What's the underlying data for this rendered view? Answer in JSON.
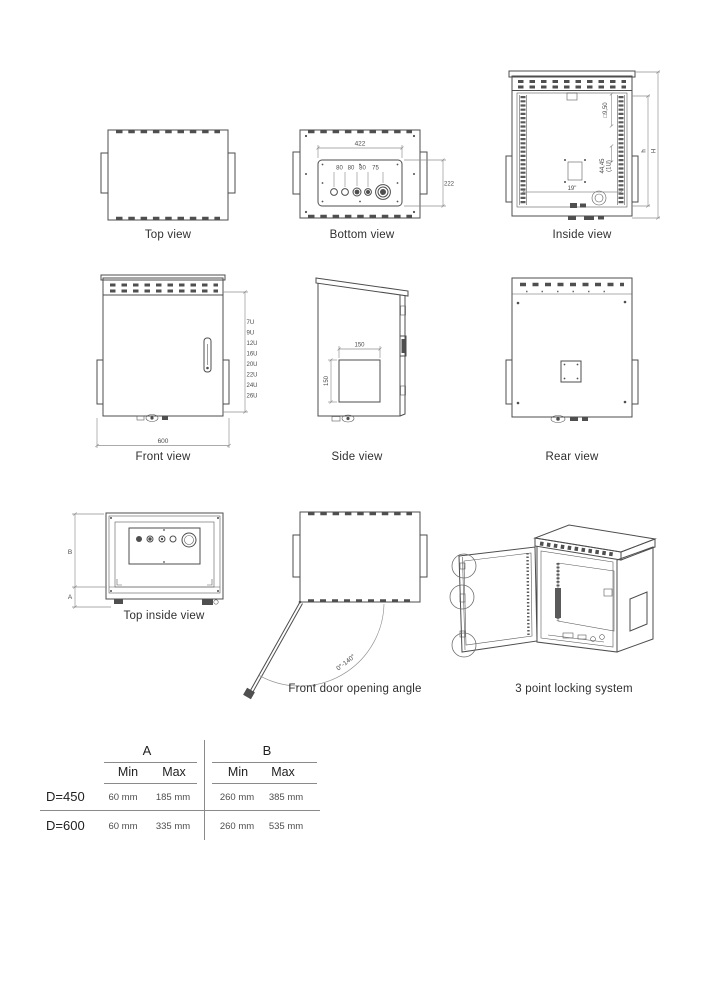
{
  "captions": {
    "top": "Top view",
    "bottom": "Bottom view",
    "inside": "Inside view",
    "front": "Front view",
    "side": "Side view",
    "rear": "Rear view",
    "top_inside": "Top inside view",
    "door_angle": "Front door opening angle",
    "locking": "3 point locking system"
  },
  "dims": {
    "bottom": {
      "width": "422",
      "s1": "80",
      "s2": "80",
      "s3": "80",
      "s4": "75",
      "height": "222"
    },
    "inside": {
      "hole": "□9,50",
      "unit_mm": "44,45",
      "unit_u": "(1U)",
      "rack": "19\"",
      "h_inner": "h",
      "h_outer": "H"
    },
    "front": {
      "width": "600",
      "units": [
        "7U",
        "9U",
        "12U",
        "16U",
        "20U",
        "22U",
        "24U",
        "26U"
      ]
    },
    "side": {
      "cut_w": "150",
      "cut_h": "150"
    },
    "top_inside": {
      "b": "B",
      "a": "A"
    },
    "door_angle": {
      "angle": "0°-140°"
    }
  },
  "table": {
    "group_a": "A",
    "group_b": "B",
    "min": "Min",
    "max": "Max",
    "rows": [
      {
        "label": "D=450",
        "a_min": "60 mm",
        "a_max": "185 mm",
        "b_min": "260 mm",
        "b_max": "385 mm"
      },
      {
        "label": "D=600",
        "a_min": "60 mm",
        "a_max": "335 mm",
        "b_min": "260 mm",
        "b_max": "535 mm"
      }
    ]
  },
  "colors": {
    "line": "#4d4d4d",
    "dim": "#8f8f8f",
    "text": "#2f2f2f",
    "bg": "#ffffff"
  }
}
